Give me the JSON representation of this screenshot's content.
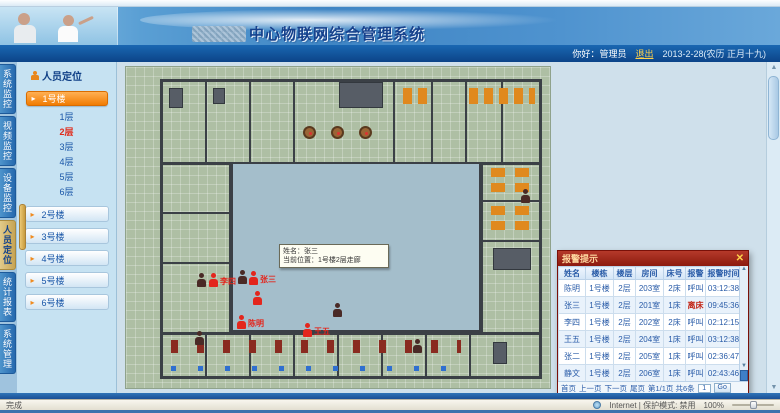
{
  "banner": {
    "title": "中心物联网综合管理系统"
  },
  "topbar": {
    "greeting": "你好：",
    "username": "管理员",
    "logout": "退出",
    "date": "2013-2-28(农历 正月十九)"
  },
  "nav_tabs": [
    {
      "label": "系统监控"
    },
    {
      "label": "视频监控"
    },
    {
      "label": "设备监控"
    },
    {
      "label": "人员定位"
    },
    {
      "label": "统计报表"
    },
    {
      "label": "系统管理"
    }
  ],
  "sidebar": {
    "header": "人员定位",
    "building_active": "1号楼",
    "floors": [
      {
        "label": "1层"
      },
      {
        "label": "2层"
      },
      {
        "label": "3层"
      },
      {
        "label": "4层"
      },
      {
        "label": "5层"
      },
      {
        "label": "6层"
      }
    ],
    "buildings": [
      {
        "label": "2号楼"
      },
      {
        "label": "3号楼"
      },
      {
        "label": "4号楼"
      },
      {
        "label": "5号楼"
      },
      {
        "label": "6号楼"
      }
    ]
  },
  "floorplan": {
    "tooltip": {
      "line1": "姓名：张三",
      "line2": "当前位置：1号楼2层走廊"
    },
    "alarm_persons": [
      {
        "label": "李四"
      },
      {
        "label": "张三"
      },
      {
        "label": ""
      },
      {
        "label": "陈明"
      },
      {
        "label": "王五"
      }
    ]
  },
  "popup": {
    "title": "报警提示",
    "close": "✕",
    "columns": [
      "姓名",
      "楼栋",
      "楼层",
      "房间",
      "床号",
      "报警",
      "报警时间"
    ],
    "rows": [
      [
        "陈明",
        "1号楼",
        "2层",
        "203室",
        "2床",
        "呼叫",
        "03:12:38"
      ],
      [
        "张三",
        "1号楼",
        "2层",
        "201室",
        "1床",
        "离床",
        "09:45:36"
      ],
      [
        "李四",
        "1号楼",
        "2层",
        "202室",
        "2床",
        "呼叫",
        "02:12:15"
      ],
      [
        "王五",
        "1号楼",
        "2层",
        "204室",
        "1床",
        "呼叫",
        "03:12:38"
      ],
      [
        "张二",
        "1号楼",
        "2层",
        "205室",
        "1床",
        "呼叫",
        "02:36:47"
      ],
      [
        "静文",
        "1号楼",
        "2层",
        "206室",
        "1床",
        "呼叫",
        "02:43:46"
      ]
    ],
    "pagination": {
      "first": "首页",
      "prev": "上一页",
      "next": "下一页",
      "last": "尾页",
      "info": "第1/1页 共6条",
      "page_value": "1",
      "go": "Go"
    }
  },
  "statusbar": {
    "left": "完成",
    "zone": "Internet | 保护模式: 禁用",
    "zoom": "100%"
  }
}
